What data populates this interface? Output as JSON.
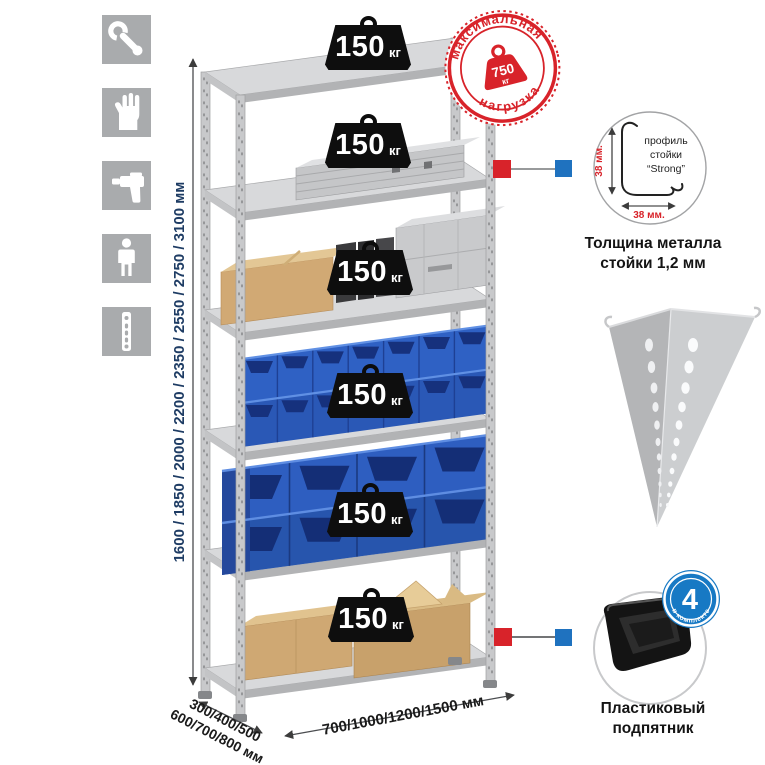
{
  "illustration": {
    "shelf_weights": [
      {
        "value": "150",
        "unit": "кг"
      },
      {
        "value": "150",
        "unit": "кг"
      },
      {
        "value": "150",
        "unit": "кг"
      },
      {
        "value": "150",
        "unit": "кг"
      },
      {
        "value": "150",
        "unit": "кг"
      },
      {
        "value": "150",
        "unit": "кг"
      }
    ]
  },
  "max_load_stamp": {
    "arc_top": "максимальная",
    "arc_bottom": "нагрузка",
    "value": "750",
    "unit": "кг"
  },
  "dimensions": {
    "height_label": "1600 / 1850 / 2000 / 2200 / 2350 / 2550 / 2750 / 3100 мм",
    "depth_line1": "300/400/500",
    "depth_line2": "600/700/800 мм",
    "width_label": "700/1000/1200/1500 мм"
  },
  "profile_detail": {
    "label_line1": "профиль",
    "label_line2": "стойки",
    "label_line3": "“Strong”",
    "dim_vertical": "38 мм.",
    "dim_horizontal": "38 мм.",
    "caption_line1": "Толщина металла",
    "caption_line2": "стойки 1,2 мм"
  },
  "foot_detail": {
    "badge_value": "4",
    "badge_arc_text": "в комплекте",
    "caption_line1": "Пластиковый",
    "caption_line2": "подпятник"
  },
  "left_icons": [
    "wrench",
    "gloves",
    "drill",
    "person",
    "rack-post"
  ],
  "colors": {
    "stamp_red": "#d8232a",
    "badge_blue": "#1779c4",
    "height_text_blue": "#1e3c64",
    "bin_blue": "#2d5fc2",
    "icon_gray": "#a9abad"
  }
}
